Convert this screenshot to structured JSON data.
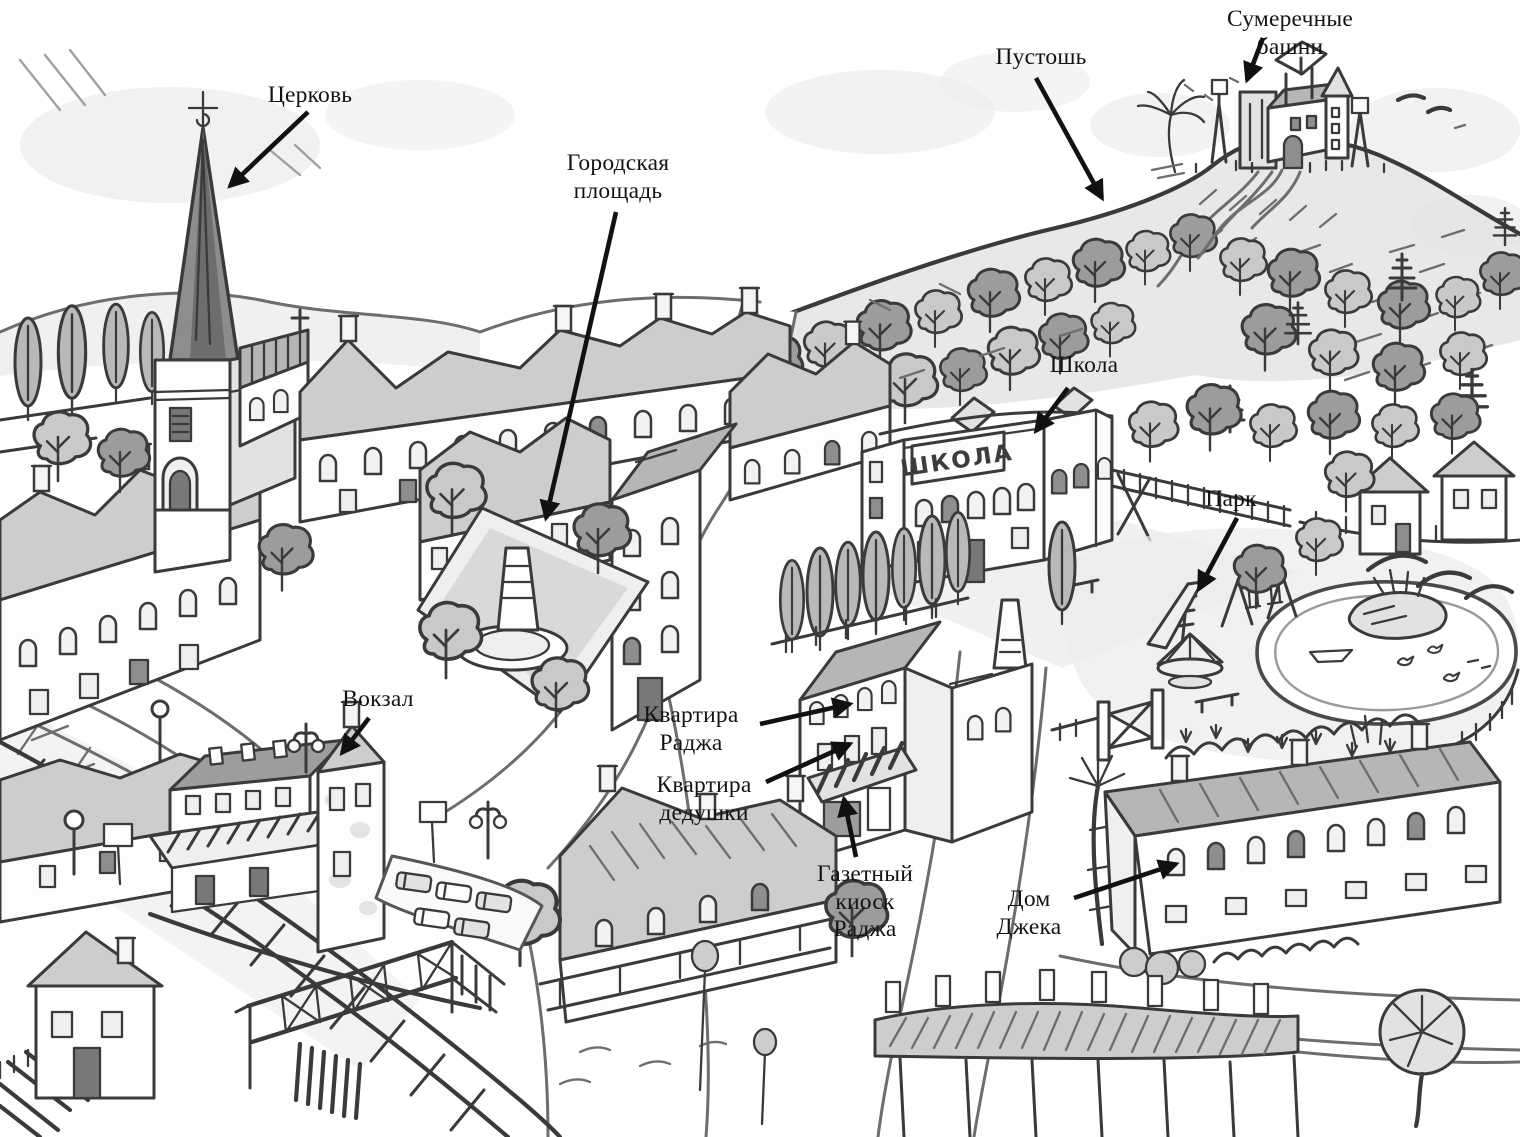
{
  "map": {
    "colors": {
      "ink": "#3a3a3a",
      "label_text": "#131313",
      "arrow": "#111111",
      "wash_light": "#ececec",
      "wash_mid": "#cdcdcd",
      "wash_dark": "#9d9d9d",
      "background": "#ffffff"
    },
    "building_signs": {
      "school": "ШКОЛА"
    },
    "labels": [
      {
        "id": "church",
        "text": "Церковь",
        "x": 310,
        "y": 82,
        "arrow": {
          "x1": 308,
          "y1": 112,
          "x2": 230,
          "y2": 186
        }
      },
      {
        "id": "town-square",
        "text": "Городская\nплощадь",
        "x": 618,
        "y": 150,
        "arrow": {
          "x1": 616,
          "y1": 212,
          "x2": 546,
          "y2": 518
        }
      },
      {
        "id": "heath",
        "text": "Пустошь",
        "x": 1041,
        "y": 44,
        "arrow": {
          "x1": 1036,
          "y1": 78,
          "x2": 1102,
          "y2": 198
        }
      },
      {
        "id": "twilight-towers",
        "text": "Сумеречные башни",
        "x": 1290,
        "y": 6,
        "arrow": {
          "x1": 1263,
          "y1": 38,
          "x2": 1247,
          "y2": 80
        }
      },
      {
        "id": "school",
        "text": "Школа",
        "x": 1084,
        "y": 352,
        "arrow": {
          "x1": 1068,
          "y1": 388,
          "x2": 1036,
          "y2": 431
        }
      },
      {
        "id": "park",
        "text": "Парк",
        "x": 1231,
        "y": 486,
        "arrow": {
          "x1": 1237,
          "y1": 518,
          "x2": 1199,
          "y2": 589
        }
      },
      {
        "id": "station",
        "text": "Вокзал",
        "x": 378,
        "y": 686,
        "arrow": {
          "x1": 369,
          "y1": 718,
          "x2": 342,
          "y2": 753
        }
      },
      {
        "id": "raj-flat",
        "text": "Квартира\nРаджа",
        "x": 691,
        "y": 702,
        "arrow": {
          "x1": 760,
          "y1": 724,
          "x2": 850,
          "y2": 704
        }
      },
      {
        "id": "grandpa-flat",
        "text": "Квартира\nдедушки",
        "x": 704,
        "y": 772,
        "arrow": {
          "x1": 766,
          "y1": 782,
          "x2": 850,
          "y2": 744
        }
      },
      {
        "id": "raj-newsstand",
        "text": "Газетный киоск\nРаджа",
        "x": 865,
        "y": 861,
        "arrow": {
          "x1": 856,
          "y1": 857,
          "x2": 844,
          "y2": 799
        }
      },
      {
        "id": "jack-house",
        "text": "Дом\nДжека",
        "x": 1029,
        "y": 886,
        "arrow": {
          "x1": 1074,
          "y1": 898,
          "x2": 1176,
          "y2": 864
        }
      }
    ]
  }
}
